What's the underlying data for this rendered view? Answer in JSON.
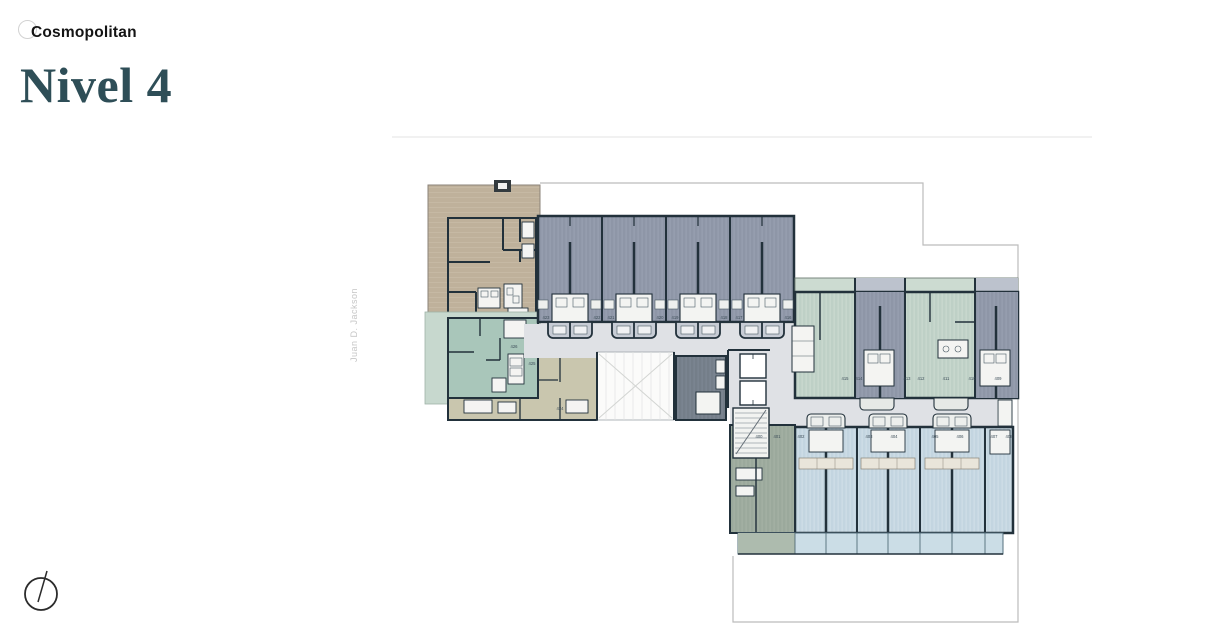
{
  "header": {
    "brand": "Cosmopolitan",
    "title": "Nivel 4"
  },
  "plan": {
    "street_label": "Juan D. Jackson",
    "unit_labels": {
      "top_row": [
        "423",
        "422",
        "421",
        "420",
        "419",
        "418",
        "417",
        "416"
      ],
      "middle_row": [
        "415",
        "414",
        "413",
        "412",
        "411",
        "410",
        "409"
      ],
      "bottom_row": [
        "400",
        "401",
        "402",
        "403",
        "404",
        "405",
        "406",
        "407",
        "408"
      ],
      "left_wing": [
        "426",
        "425",
        "424"
      ]
    },
    "colors": {
      "title_text": "#2e4e57",
      "wall": "#22313b",
      "tan_unit": "#bfb19b",
      "gray_unit": "#8e96a7",
      "green_unit": "#bed0c6",
      "blue_unit": "#c3d5e0",
      "teal_unit": "#a9c6ba",
      "olive_unit": "#c9c6ae",
      "sage_unit": "#9ba99c",
      "corridor": "#dfe1e5",
      "boundary_line": "#bcbcbc"
    }
  }
}
